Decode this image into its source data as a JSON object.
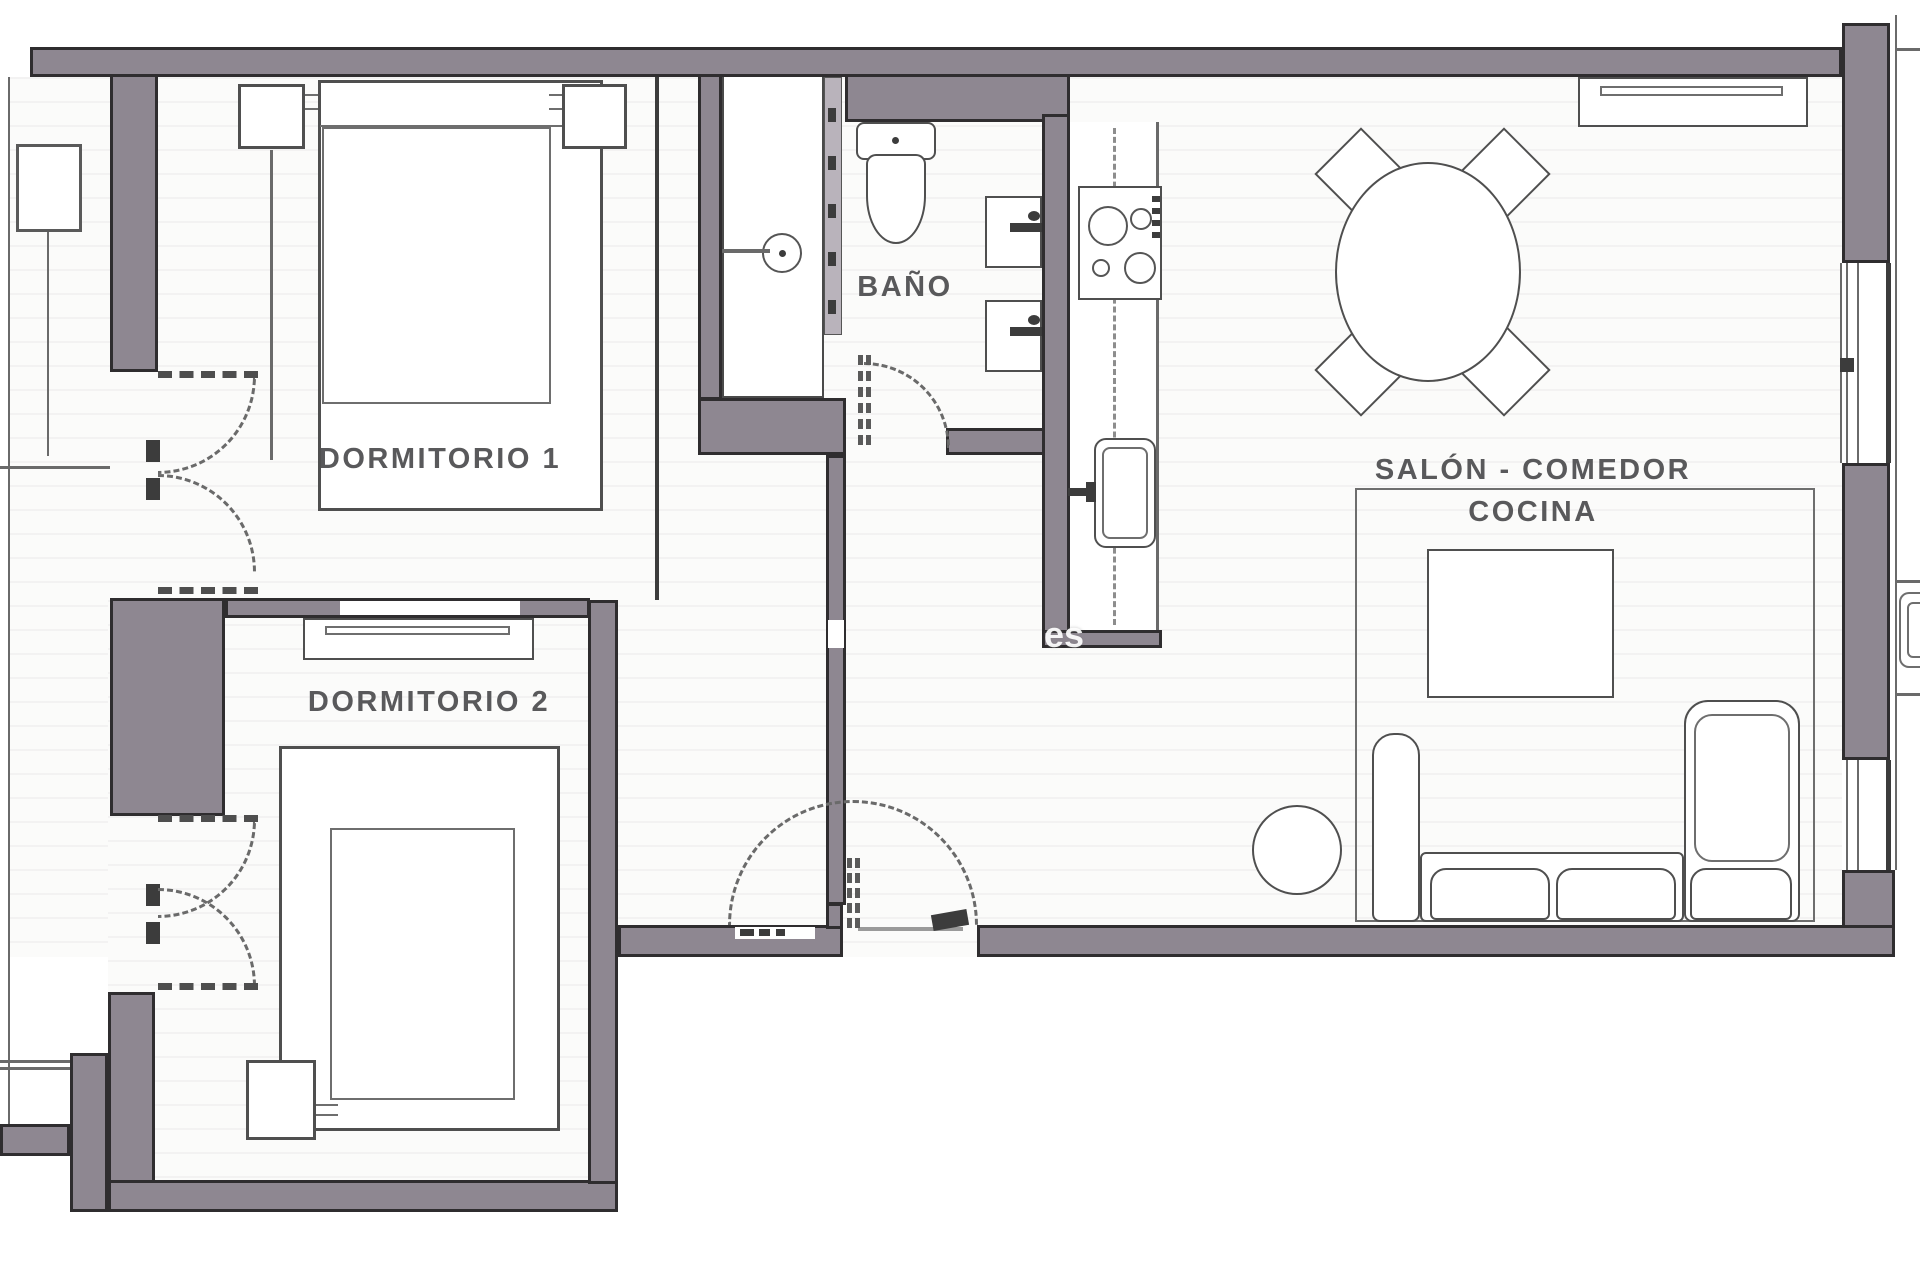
{
  "title": "Floor plan",
  "labels": {
    "room1": "DORMITORIO 1",
    "room2": "DORMITORIO 2",
    "bath": "BAÑO",
    "living_line1": "SALÓN - COMEDOR",
    "living_line2": "COCINA",
    "watermark": "es"
  },
  "colors": {
    "wall_fill": "#8e8791",
    "wall_stroke": "#2f2d2f",
    "label": "#59595b",
    "glass": "#b9b3bb"
  }
}
